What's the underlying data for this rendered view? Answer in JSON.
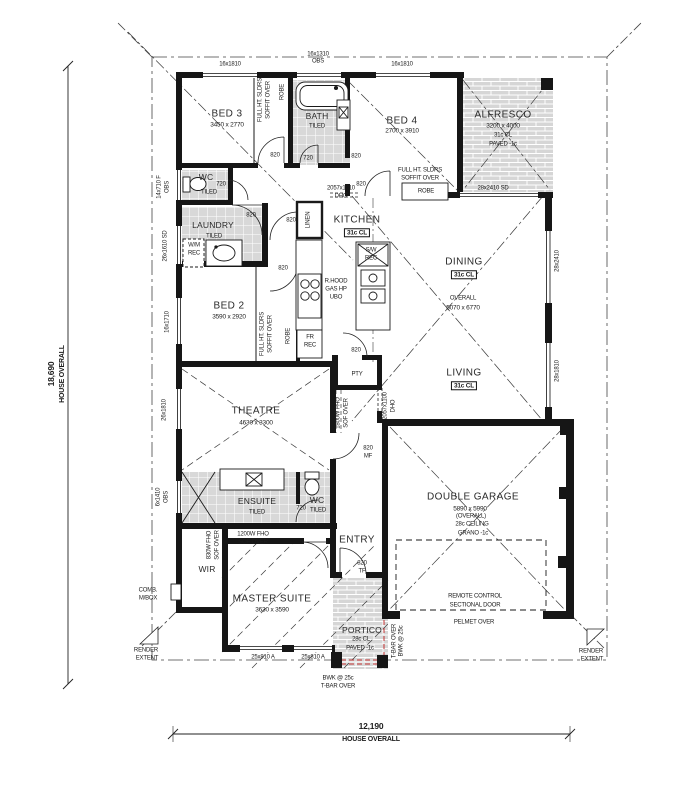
{
  "dims": {
    "left_value": "18,690",
    "left_label": "HOUSE OVERALL",
    "bottom_value": "12,190",
    "bottom_label": "HOUSE OVERALL"
  },
  "render_extent": {
    "line1": "RENDER",
    "line2": "EXTENT"
  },
  "rooms": {
    "bed3": {
      "name": "BED 3",
      "dims": "3450 x 2770"
    },
    "bath": {
      "name": "BATH",
      "finish": "TILED"
    },
    "bed4": {
      "name": "BED 4",
      "dims": "2700 x 3910"
    },
    "alfresco": {
      "name": "ALFRESCO",
      "dims": "3200 x 4000",
      "ceiling": "31c CL",
      "finish": "PAVED -1c"
    },
    "wc1": {
      "name": "WC",
      "finish": "TILED"
    },
    "laundry": {
      "name": "LAUNDRY",
      "finish": "TILED"
    },
    "kitchen": {
      "name": "KITCHEN",
      "ceiling": "31c CL"
    },
    "dining": {
      "name": "DINING",
      "ceiling": "31c CL"
    },
    "living": {
      "name": "LIVING",
      "ceiling": "31c CL"
    },
    "open_plan": {
      "label": "OVERALL",
      "dims": "5070 x 6770"
    },
    "bed2": {
      "name": "BED 2",
      "dims": "3590 x 2920"
    },
    "theatre": {
      "name": "THEATRE",
      "dims": "4630 x 3300"
    },
    "ensuite": {
      "name": "ENSUITE",
      "finish": "TILED"
    },
    "wc2": {
      "name": "WC",
      "finish": "TILED"
    },
    "wir": {
      "name": "WIR"
    },
    "master": {
      "name": "MASTER SUITE",
      "dims": "3630 x 3590"
    },
    "entry": {
      "name": "ENTRY"
    },
    "garage": {
      "name": "DOUBLE GARAGE",
      "dims": "5890 x 5990",
      "note1": "(OVERALL)",
      "note2": "28c CEILING",
      "note3": "GRANO -1c"
    },
    "portico": {
      "name": "PORTICO",
      "ceiling": "28c CL",
      "finish": "PAVED -1c"
    }
  },
  "windows": {
    "bed3_top": "16x1810",
    "bath_top1": "16x1310",
    "bath_top2": "OBS",
    "bed4_top": "16x1810",
    "wc1_a": "14x710 F",
    "wc1_b": "OBS",
    "laundry_side": "26x1610 SD",
    "bed2_side": "16x1710",
    "theatre_side": "26x1810",
    "ensuite_a": "6x1410",
    "ensuite_b": "OBS",
    "dining_side": "28x2410",
    "living_side": "28x1810",
    "alfresco_door": "28x2410 SD",
    "master_a": "25x810 A",
    "master_b": "25x810 A"
  },
  "doors": {
    "d820": "820",
    "d720": "720",
    "mf": "MF",
    "tf": "TF"
  },
  "openings": {
    "dho1_a": "2057x1010",
    "dho1_b": "DHO",
    "dho2_a": "2057x1100",
    "dho2_b": "DHO"
  },
  "fittings": {
    "robe": "ROBE",
    "linen": "LINEN",
    "pantry": "PTY",
    "fr_a": "FR",
    "fr_b": "REC",
    "wm_a": "W/M",
    "wm_b": "REC",
    "rhood_a": "R.HOOD",
    "rhood_b": "GAS HP",
    "rhood_c": "UBO",
    "sw_a": "S/W",
    "sw_b": "REC",
    "mbox_a": "COMB.",
    "mbox_b": "M/BOX"
  },
  "notes": {
    "fullht_a": "FULL HT. SLDRS",
    "fullht_b": "SOFFIT OVER",
    "fho1800_a": "1800W FHO",
    "fho1800_b": "SOF OVER",
    "fho1200_a": "1200W FHO",
    "fho1200_b": "SOF OVER",
    "fho830_a": "830W FHO",
    "fho830_b": "SOF OVER",
    "gdoor_a": "REMOTE CONTROL",
    "gdoor_b": "SECTIONAL DOOR",
    "pelmet": "PELMET OVER",
    "tbar_a": "T-BAR OVER",
    "tbar_b": "BWK @ 25c"
  }
}
